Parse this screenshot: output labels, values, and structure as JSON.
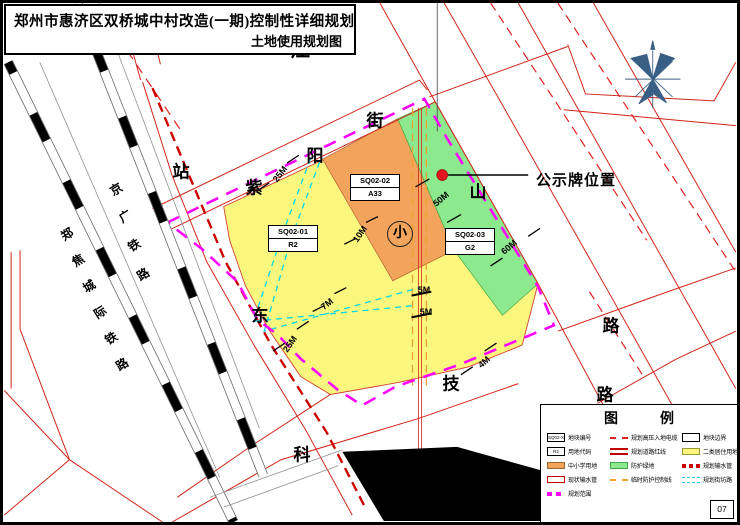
{
  "title": {
    "line1": "郑州市惠济区双桥城中村改造(一期)控制性详细规划",
    "line2": "土地使用规划图"
  },
  "notice": {
    "label": "公示牌位置"
  },
  "school_symbol": "小",
  "page_number": "07",
  "parcels": [
    {
      "id": "SQ02-01",
      "code": "R2"
    },
    {
      "id": "SQ02-02",
      "code": "A33"
    },
    {
      "id": "SQ02-03",
      "code": "G2"
    }
  ],
  "street_chars": [
    "江",
    "山",
    "路",
    "紫",
    "阳",
    "街",
    "站",
    "东",
    "科",
    "技",
    "路",
    "路"
  ],
  "railway_chars": [
    "京",
    "广",
    "铁",
    "路",
    "郑",
    "焦",
    "城",
    "际",
    "铁",
    "路"
  ],
  "railways": [
    "京广铁路",
    "郑焦城际铁路"
  ],
  "streets": [
    "江山路",
    "紫阳街",
    "科技路"
  ],
  "dims": [
    "25M",
    "25M",
    "10M",
    "7M",
    "50M",
    "60M",
    "4M",
    "5M",
    "5M"
  ],
  "legend": {
    "title": "图　例",
    "items": [
      {
        "key": "parcel-number",
        "label": "地块编号",
        "swatch_text": "SQ02-X"
      },
      {
        "key": "hv-cable",
        "label": "规划高压入地电缆"
      },
      {
        "key": "parcel-boundary",
        "label": "地块边界"
      },
      {
        "key": "land-code",
        "label": "用地代码",
        "swatch_text": "R2"
      },
      {
        "key": "road-redline",
        "label": "规划道路红线"
      },
      {
        "key": "residential",
        "label": "二类居住用地"
      },
      {
        "key": "school",
        "label": "中小学用地"
      },
      {
        "key": "green-buffer",
        "label": "防护绿地"
      },
      {
        "key": "planned-water-pipe",
        "label": "规划输水管"
      },
      {
        "key": "existing-water-pipe",
        "label": "现状输水管"
      },
      {
        "key": "temp-protection-line",
        "label": "临时防护控制线"
      },
      {
        "key": "neighborhood-road",
        "label": "规划街坊路"
      },
      {
        "key": "planning-scope",
        "label": "规划范围"
      }
    ]
  },
  "colors": {
    "residential_yellow": "#FBF77E",
    "school_orange": "#F2A45C",
    "buffer_green": "#8DE98D",
    "planning_scope_magenta": "#FF00FF",
    "neighborhood_road_cyan": "#00D5E5",
    "road_red": "#D02418",
    "water_pipe_red": "#CC0000",
    "temp_protection_orange": "#F0A030",
    "notice_dot_red": "#E8141E",
    "north_arrow_blue": "#3A5F85"
  }
}
